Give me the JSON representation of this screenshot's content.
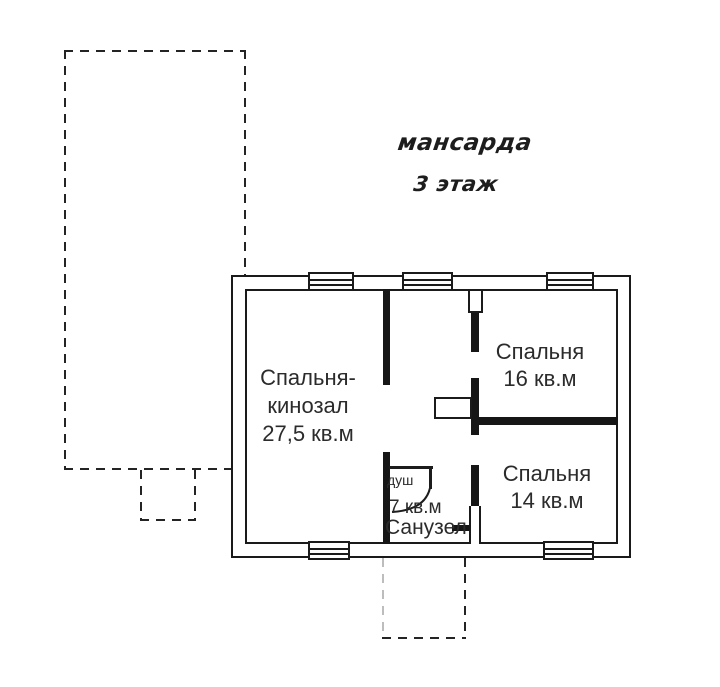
{
  "colors": {
    "line": "#1a1a1a",
    "paper": "#ffffff",
    "text": "#2b2b2b"
  },
  "title": {
    "line1": "мансарда",
    "line2": "3 этаж"
  },
  "rooms": {
    "bedroom_cinema": {
      "name_line1": "Спальня-",
      "name_line2": "кинозал",
      "area": "27,5 кв.м"
    },
    "bedroom_16": {
      "name": "Спальня",
      "area": "16 кв.м"
    },
    "bedroom_14": {
      "name": "Спальня",
      "area": "14 кв.м"
    },
    "bathroom": {
      "name": "Санузел",
      "area": "7 кв.м",
      "shower": "душ"
    }
  }
}
